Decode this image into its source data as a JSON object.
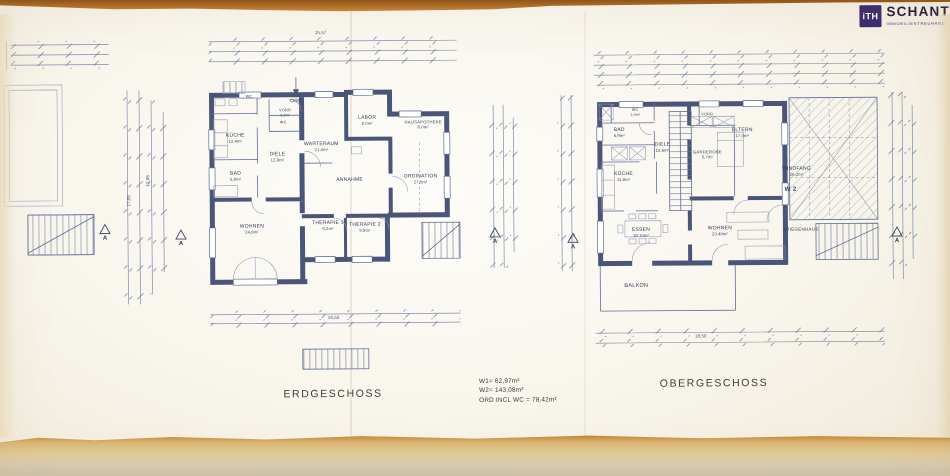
{
  "logo": {
    "badge": "iTH",
    "name": "SCHANTL",
    "subtitle": "IMMOBILIENTREUHAND"
  },
  "titles": {
    "eg": "ERDGESCHOSS",
    "og": "OBERGESCHOSS"
  },
  "summary": {
    "w1": "W1= 62,97m²",
    "w2": "W2= 143,08m²",
    "ord": "ORD INCL WC = 78,42m²"
  },
  "dims": {
    "eg_top": "15,57",
    "eg_bottom": "18,50",
    "og_bottom": "18,50",
    "left_a": "12,95",
    "left_b": "17,05"
  },
  "markers": {
    "section": "A",
    "unit": "W 2"
  },
  "rooms": {
    "eg": {
      "wc1": {
        "label": "WC",
        "area": ""
      },
      "kueche": {
        "label": "KÜCHE",
        "area": "12,4m²"
      },
      "ord": {
        "label": "ORD",
        "area": ""
      },
      "vorr": {
        "label": "VORR",
        "area": "3,2m²"
      },
      "wc2": {
        "label": "WC",
        "area": ""
      },
      "labor": {
        "label": "LABOR",
        "area": "8,0m²"
      },
      "hausapotheke": {
        "label": "HAUSAPOTHEKE",
        "area": "8,0m²"
      },
      "warteraum": {
        "label": "WARTERAUM",
        "area": "21,6m²"
      },
      "diele": {
        "label": "DIELE",
        "area": "12,8m²"
      },
      "bad": {
        "label": "BAD",
        "area": "5,8m²"
      },
      "annahme": {
        "label": "ANNAHME",
        "area": ""
      },
      "ordination": {
        "label": "ORDINATION",
        "area": "27,5m²"
      },
      "wohnen": {
        "label": "WOHNEN",
        "area": "24,8m²"
      },
      "therapie1": {
        "label": "THERAPIE 1",
        "area": "9,2m²"
      },
      "therapie2": {
        "label": "THERAPIE 2",
        "area": "9,8m²"
      }
    },
    "og": {
      "wc": {
        "label": "WC",
        "area": "1,9m²"
      },
      "bad": {
        "label": "BAD",
        "area": "6,9m²"
      },
      "kueche": {
        "label": "KÜCHE",
        "area": "11,8m²"
      },
      "diele": {
        "label": "DIELE",
        "area": "12,6m²"
      },
      "vorr": {
        "label": "VORR",
        "area": ""
      },
      "eltern": {
        "label": "ELTERN",
        "area": "17,0m²"
      },
      "garderobe": {
        "label": "GARDEROBE",
        "area": "5,7m²"
      },
      "windfang": {
        "label": "WINDFANG",
        "area": "26,2m²"
      },
      "essen": {
        "label": "ESSEN",
        "area": "18,10m²"
      },
      "wohnen": {
        "label": "WOHNEN",
        "area": "23,40m²"
      },
      "stiegenhaus": {
        "label": "STIEGENHAUS",
        "area": ""
      },
      "balkon": {
        "label": "BALKON",
        "area": ""
      }
    }
  }
}
